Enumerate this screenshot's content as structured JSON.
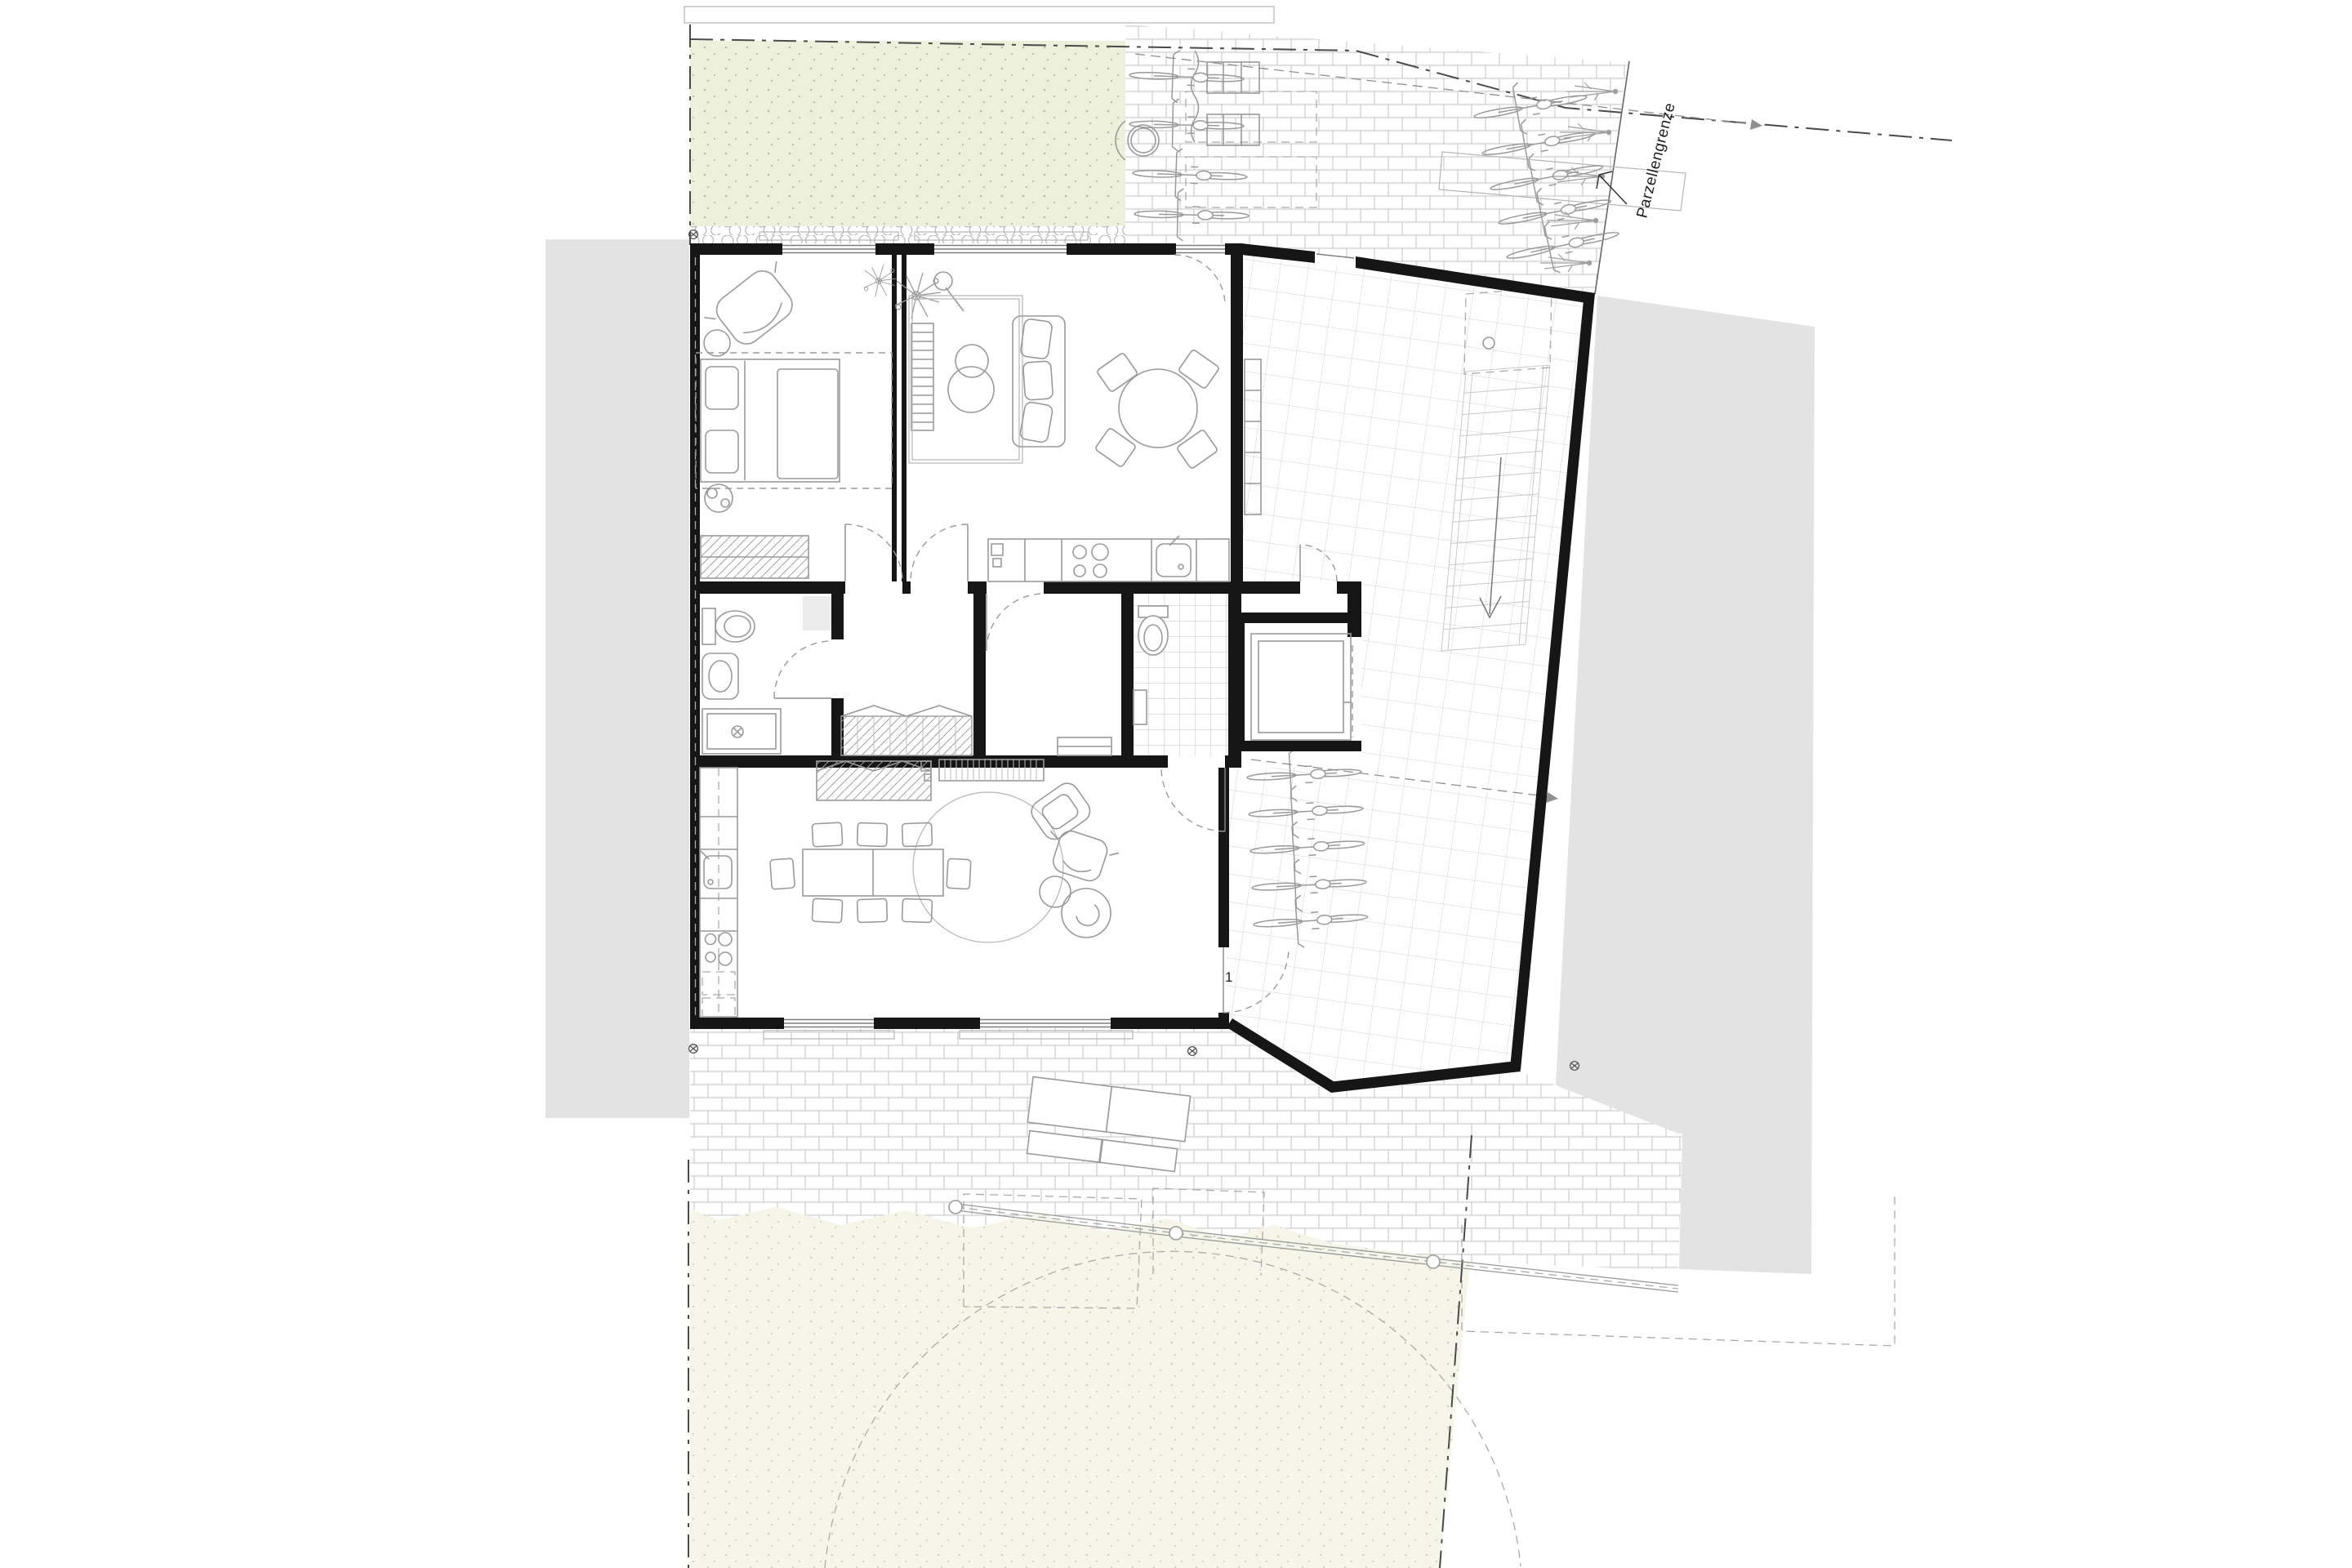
{
  "annotations": {
    "parcel_boundary_label": "Parzellengrenze",
    "door_number_label": "1"
  },
  "colors": {
    "wall": "#161616",
    "neighbor_building": "#e3e3e3",
    "lawn_top": "#edf0da",
    "lawn_bottom": "#f5f6e9",
    "paving_stroke": "#c3c3c3",
    "tile_stroke": "#d0d0d0",
    "furniture_stroke": "#9a9a9a",
    "boundary_stroke": "#4a4a4a"
  }
}
